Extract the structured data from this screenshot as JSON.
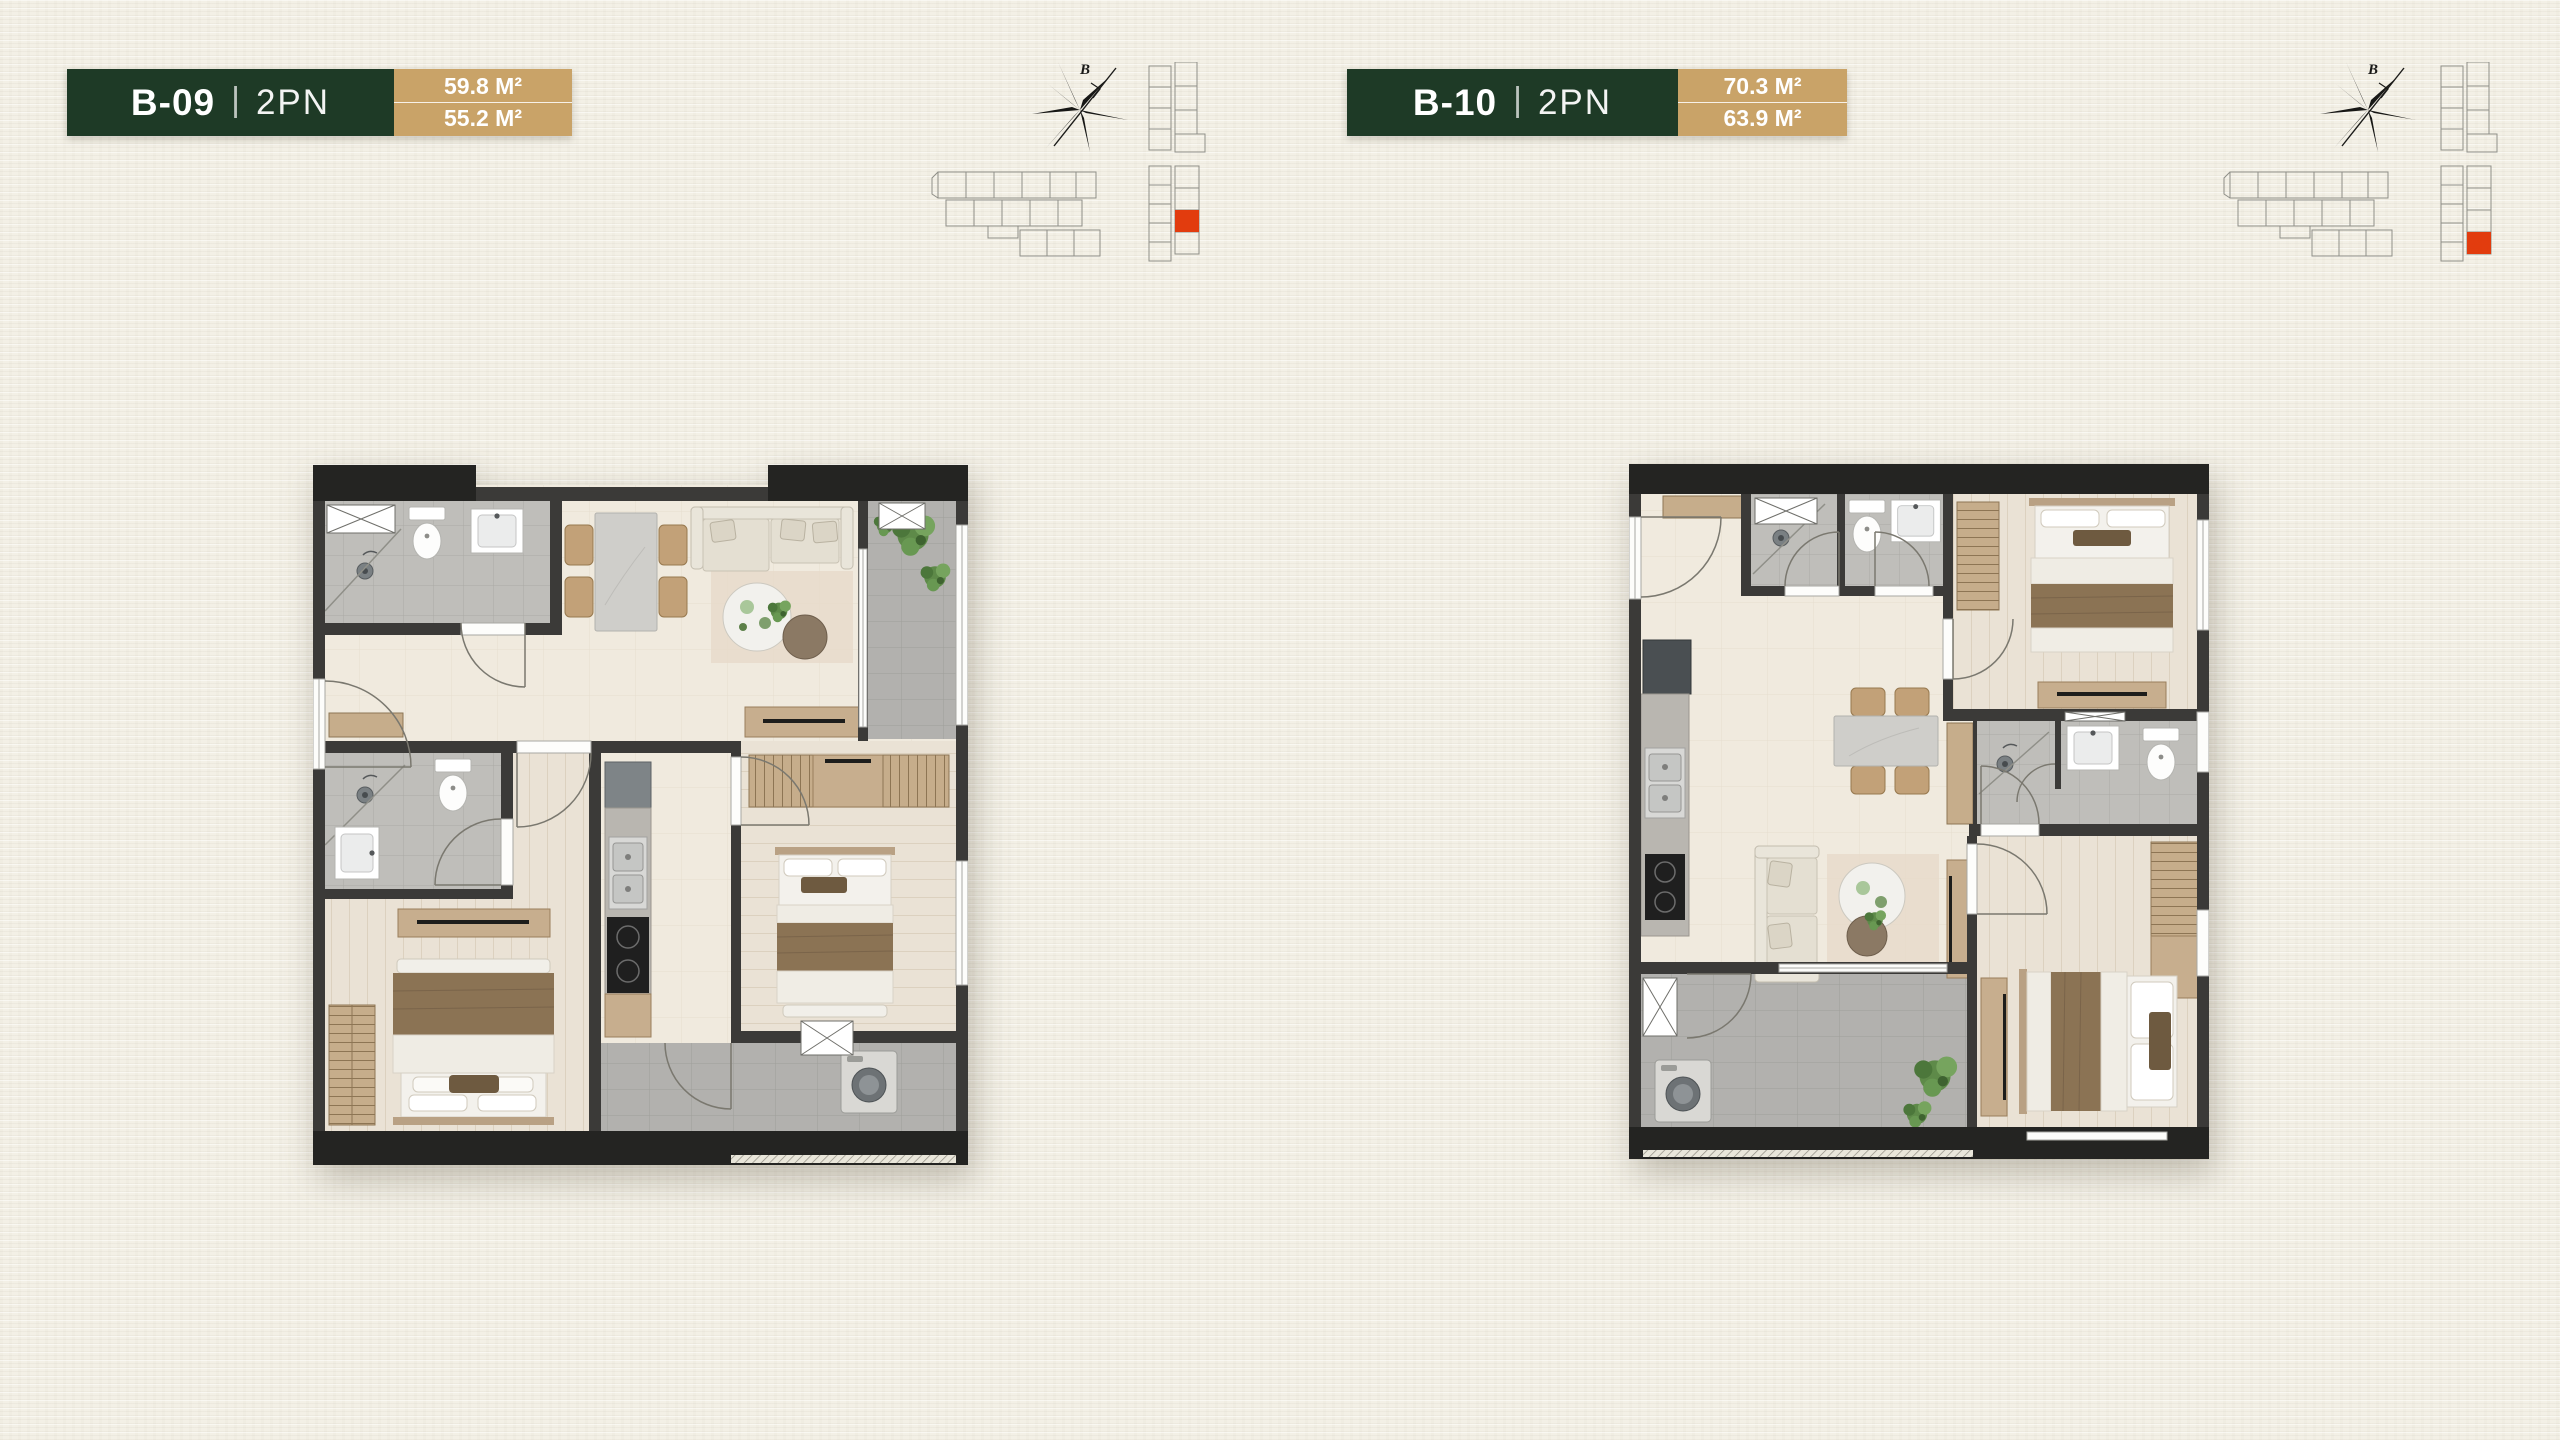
{
  "background": {
    "style": "textured-paper"
  },
  "colors": {
    "green": "#1e3a26",
    "tan": "#c9a368",
    "red": "#e23c0e",
    "cream": "#f3f0e6",
    "wall": "#3b3a38"
  },
  "units": [
    {
      "code": "B-09",
      "separator": "|",
      "bedrooms": "2PN",
      "area_construction": "59.8 M²",
      "area_usable": "55.2 M²",
      "compass_label": "B",
      "keyplan_red_transform": "translate(29,148)"
    },
    {
      "code": "B-10",
      "separator": "|",
      "bedrooms": "2PN",
      "area_construction": "70.3 M²",
      "area_usable": "63.9 M²",
      "compass_label": "B",
      "keyplan_red_transform": "translate(29,170)"
    }
  ]
}
